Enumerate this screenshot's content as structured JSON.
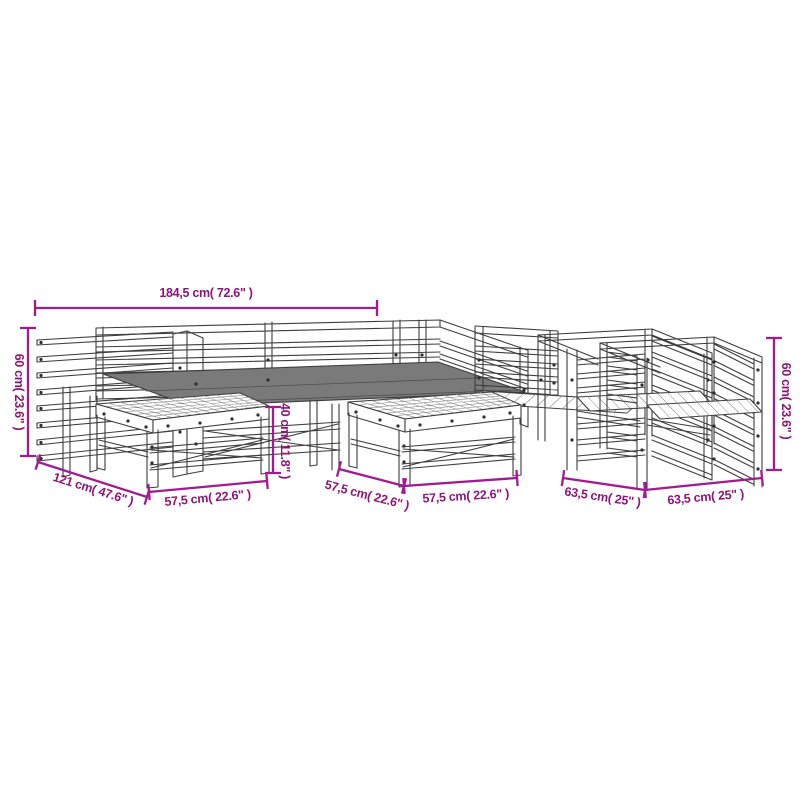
{
  "diagram": {
    "type": "product-dimension-diagram",
    "subject": "wooden-garden-lounge-set-line-drawing",
    "colors": {
      "background": "#ffffff",
      "outline": "#3d3d3d",
      "seat_fill": "#7a7a7a",
      "dimension_line": "#a21a90",
      "dimension_text": "#8e1578"
    },
    "dimensions": {
      "overall_width": "184,5 cm( 72.6\" )",
      "sofa_height_left": "60 cm( 23.6\" )",
      "sofa_depth": "121 cm( 47.6\" )",
      "table_left_width": "57,5 cm( 22.6\" )",
      "table_height": "40 cm( 11.8\" )",
      "table_center_depth": "57,5 cm( 22.6\" )",
      "table_center_width": "57,5 cm( 22.6\" )",
      "chair_depth": "63,5 cm( 25\" )",
      "chair_width": "63,5 cm( 25\" )",
      "chair_height_right": "60 cm( 23.6\" )"
    }
  }
}
